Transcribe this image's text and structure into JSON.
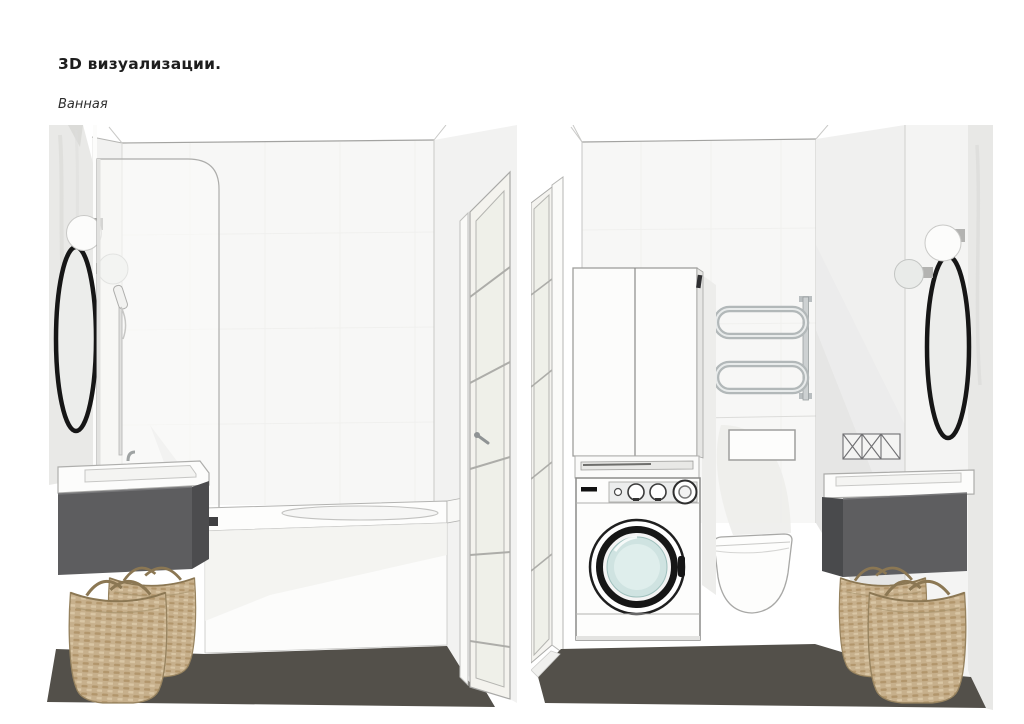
{
  "page": {
    "title": "3D визуализации.",
    "subtitle": "Ванная"
  },
  "palette": {
    "floor": "#53504a",
    "vanity_cabinet": "#5d5d5f",
    "wicker_basket": "#c7b08c",
    "mirror_frame": "#161616",
    "washer_glass": "#cfe3e1",
    "chrome": "#b5babb",
    "wall": "#f6f6f5",
    "door_glass": "#eff0e9"
  },
  "renders": {
    "left": {
      "name": "bathroom-view-bathtub",
      "items": [
        "oval-mirror",
        "wall-sconces",
        "marble-wall-panel",
        "shower-glass-screen",
        "hand-shower",
        "bathtub",
        "interior-glass-door",
        "vanity-sink",
        "vanity-cabinet",
        "wicker-baskets",
        "dark-floor"
      ]
    },
    "right": {
      "name": "bathroom-view-laundry-wc",
      "items": [
        "interior-glass-door",
        "storage-cabinet",
        "washing-machine",
        "towel-radiator",
        "flush-plate",
        "wall-hung-toilet",
        "vent-grille",
        "oval-mirror",
        "wall-sconces",
        "vanity-sink",
        "vanity-cabinet",
        "wicker-baskets",
        "dark-floor"
      ]
    }
  }
}
